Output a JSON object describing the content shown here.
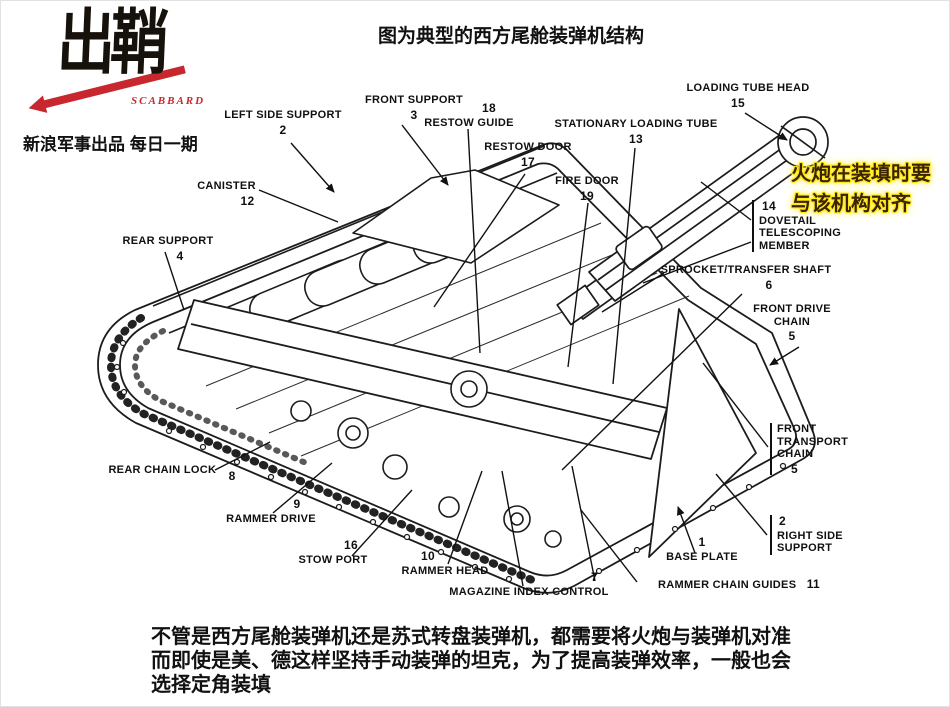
{
  "logo": {
    "wordmark": "出鞘",
    "latin": "SCABBARD",
    "tagline": "新浪军事出品 每日一期"
  },
  "header": {
    "title": "图为典型的西方尾舱装弹机结构"
  },
  "note": {
    "lines": [
      "火炮在装填时要",
      "与该机构对齐"
    ]
  },
  "footer": {
    "lines": [
      "不管是西方尾舱装弹机还是苏式转盘装弹机，都需要将火炮与装弹机对准",
      "而即使是美、德这样坚持手动装弹的坦克，为了提高装弹效率，一般也会",
      "选择定角装填"
    ]
  },
  "colors": {
    "accent_red": "#c8282d",
    "highlight_yellow": "#ffe81a",
    "note_text": "#3a2400",
    "ink": "#1a1a1a"
  },
  "diagram": {
    "labels": [
      {
        "text": "LEFT SIDE SUPPORT",
        "num": "2"
      },
      {
        "text": "FRONT SUPPORT",
        "num": "3"
      },
      {
        "text": "RESTOW GUIDE",
        "num": "18"
      },
      {
        "text": "RESTOW DOOR",
        "num": "17"
      },
      {
        "text": "STATIONARY LOADING TUBE",
        "num": "13"
      },
      {
        "text": "FIRE DOOR",
        "num": "19"
      },
      {
        "text": "LOADING TUBE HEAD",
        "num": "15"
      },
      {
        "text": "CANISTER",
        "num": "12"
      },
      {
        "text": "REAR SUPPORT",
        "num": "4"
      },
      {
        "text": "DOVETAIL\nTELESCOPING\nMEMBER",
        "num": "14"
      },
      {
        "text": "SPROCKET/TRANSFER SHAFT",
        "num": "6"
      },
      {
        "text": "FRONT DRIVE\nCHAIN",
        "num": "5"
      },
      {
        "text": "FRONT\nTRANSPORT\nCHAIN",
        "num": "5"
      },
      {
        "text": "RIGHT SIDE\nSUPPORT",
        "num": "2"
      },
      {
        "text": "BASE PLATE",
        "num": "1"
      },
      {
        "text": "RAMMER CHAIN GUIDES",
        "num": "11"
      },
      {
        "text": "MAGAZINE INDEX CONTROL",
        "num": "7"
      },
      {
        "text": "RAMMER HEAD",
        "num": "10"
      },
      {
        "text": "STOW PORT",
        "num": "16"
      },
      {
        "text": "RAMMER DRIVE",
        "num": "9"
      },
      {
        "text": "REAR CHAIN LOCK",
        "num": "8"
      }
    ]
  }
}
